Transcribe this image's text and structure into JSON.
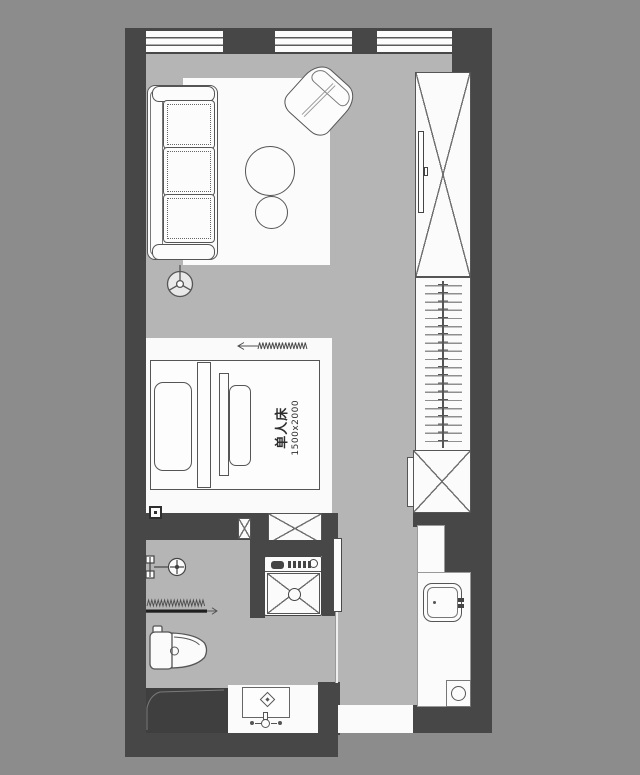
{
  "plan": {
    "type": "studio-apartment-floor-plan",
    "bed": {
      "label": "单人床",
      "dimensions": "1500x2000"
    },
    "colors": {
      "background": "#8c8c8c",
      "floor": "#b5b5b5",
      "wall": "#474747",
      "fixture_white": "#fbfbfb",
      "line": "#555555"
    },
    "rooms": {
      "living": [
        "sofa",
        "armchair",
        "coffee-table",
        "side-table",
        "floor-lamp",
        "rug"
      ],
      "sleeping": [
        "single-bed",
        "pillows",
        "curtain-track"
      ],
      "storage": [
        "tv-cabinet",
        "hanging-wardrobe",
        "low-cabinet",
        "hall-cabinet",
        "column"
      ],
      "bathroom": [
        "shower-head",
        "shower-screen",
        "toilet",
        "washing-machine",
        "wash-basin",
        "counter-sink",
        "floor-drain",
        "duct-shaft"
      ],
      "windows": 3,
      "entry": "bottom-opening"
    }
  }
}
